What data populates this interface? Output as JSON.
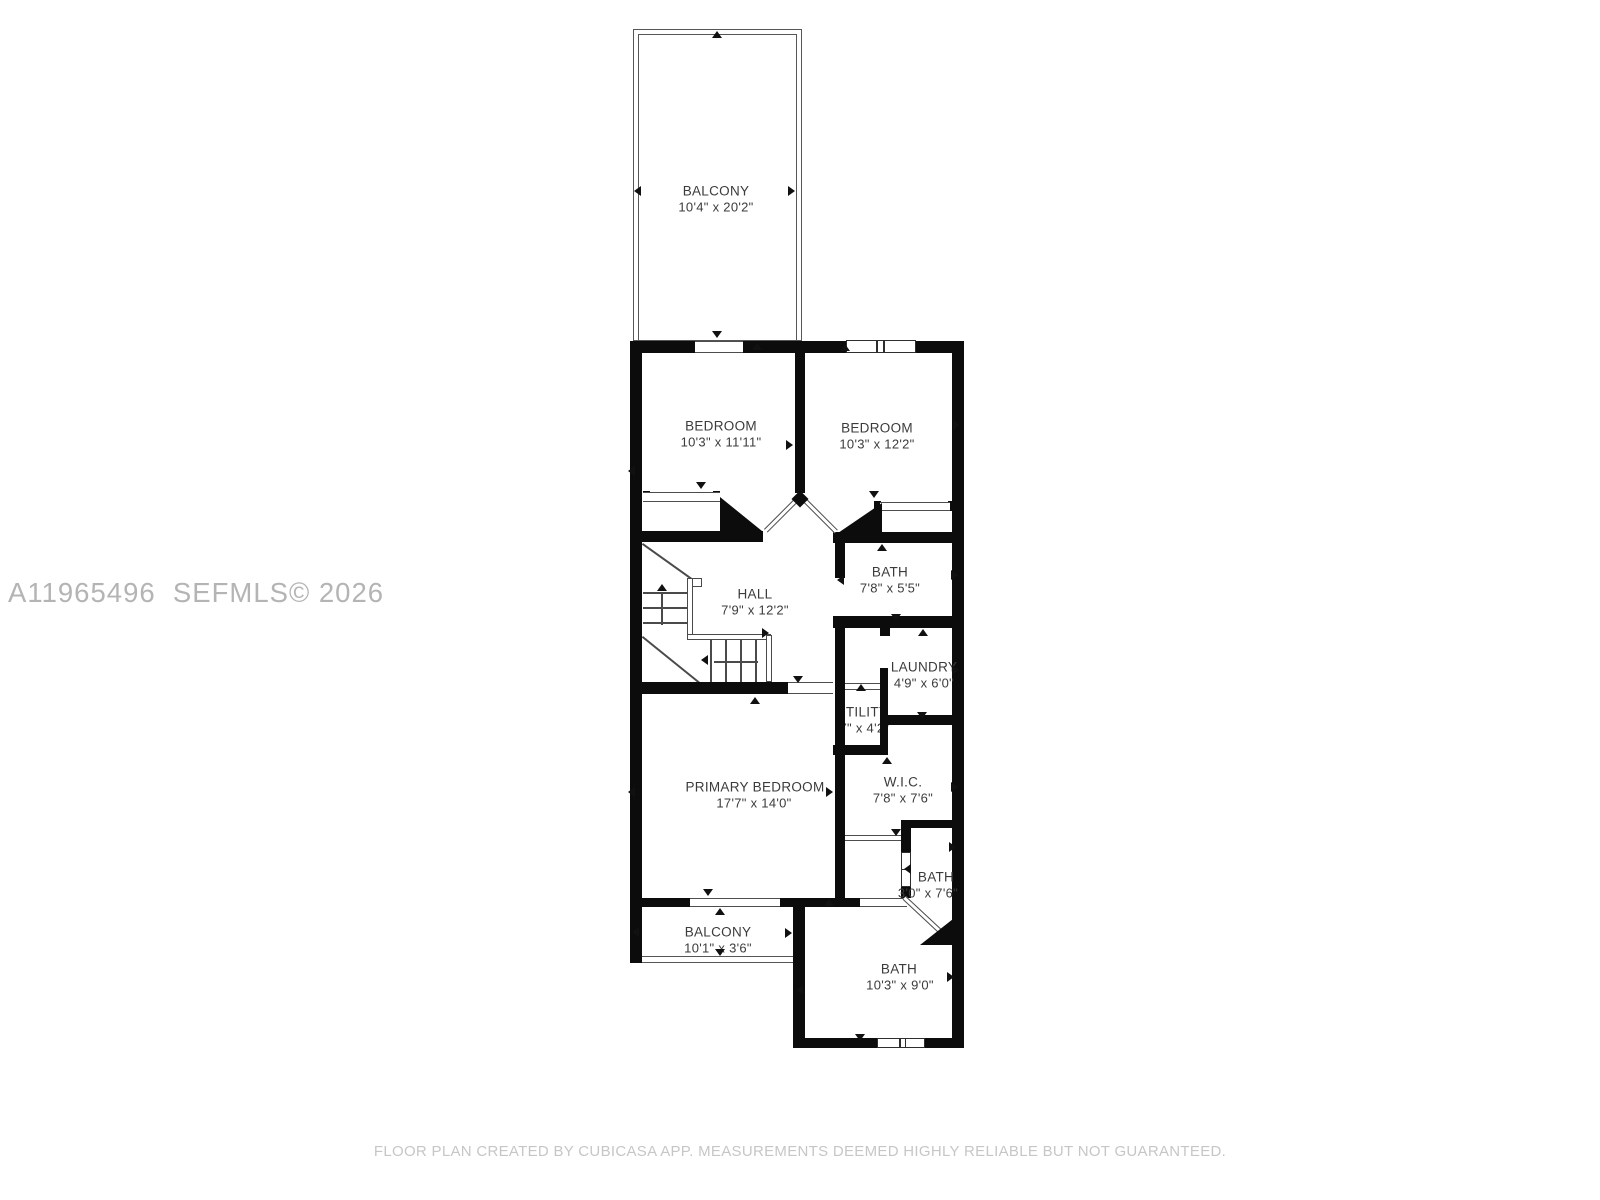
{
  "watermark": "A11965496  SEFMLS© 2026",
  "footer": "FLOOR PLAN CREATED BY CUBICASA APP. MEASUREMENTS DEEMED HIGHLY RELIABLE BUT NOT GUARANTEED.",
  "rooms": [
    {
      "id": "balcony-top",
      "name": "BALCONY",
      "dims": "10'4\" x 20'2\"",
      "nx": 716,
      "ny": 191,
      "dx": 716,
      "dy": 207,
      "under": false
    },
    {
      "id": "bedroom-left",
      "name": "BEDROOM",
      "dims": "10'3\" x 11'11\"",
      "nx": 721,
      "ny": 426,
      "dx": 721,
      "dy": 442,
      "under": false
    },
    {
      "id": "bedroom-right",
      "name": "BEDROOM",
      "dims": "10'3\" x 12'2\"",
      "nx": 877,
      "ny": 428,
      "dx": 877,
      "dy": 444,
      "under": false
    },
    {
      "id": "hall",
      "name": "HALL",
      "dims": "7'9\" x 12'2\"",
      "nx": 755,
      "ny": 594,
      "dx": 755,
      "dy": 610,
      "under": false
    },
    {
      "id": "bath-upper",
      "name": "BATH",
      "dims": "7'8\" x 5'5\"",
      "nx": 890,
      "ny": 572,
      "dx": 890,
      "dy": 588,
      "under": false
    },
    {
      "id": "laundry",
      "name": "LAUNDRY",
      "dims": "4'9\" x 6'0\"",
      "nx": 924,
      "ny": 667,
      "dx": 924,
      "dy": 683,
      "under": false
    },
    {
      "id": "utility",
      "name": "UTILITY",
      "dims": "'7\" x 4'2\"",
      "nx": 862,
      "ny": 712,
      "dx": 863,
      "dy": 728,
      "under": true
    },
    {
      "id": "wic",
      "name": "W.I.C.",
      "dims": "7'8\" x 7'6\"",
      "nx": 903,
      "ny": 782,
      "dx": 903,
      "dy": 798,
      "under": false
    },
    {
      "id": "primary-bedroom",
      "name": "PRIMARY BEDROOM",
      "dims": "17'7\" x 14'0\"",
      "nx": 755,
      "ny": 787,
      "dx": 754,
      "dy": 803,
      "under": false
    },
    {
      "id": "balcony-bottom",
      "name": "BALCONY",
      "dims": "10'1\" x 3'6\"",
      "nx": 718,
      "ny": 932,
      "dx": 718,
      "dy": 948,
      "under": false
    },
    {
      "id": "bath-small",
      "name": "BATH",
      "dims": "3'0\" x 7'6\"",
      "nx": 936,
      "ny": 877,
      "dx": 928,
      "dy": 893,
      "under": false
    },
    {
      "id": "bath-big",
      "name": "BATH",
      "dims": "10'3\" x 9'0\"",
      "nx": 899,
      "ny": 969,
      "dx": 900,
      "dy": 985,
      "under": false
    }
  ],
  "geometry": {
    "walls": [
      [
        630,
        341,
        334,
        12
      ],
      [
        630,
        341,
        12,
        622
      ],
      [
        952,
        341,
        12,
        707
      ],
      [
        795,
        353,
        10,
        140
      ],
      [
        630,
        531,
        133,
        11
      ],
      [
        833,
        532,
        131,
        11
      ],
      [
        835,
        543,
        10,
        35
      ],
      [
        833,
        616,
        131,
        12
      ],
      [
        835,
        628,
        10,
        54
      ],
      [
        630,
        682,
        158,
        12
      ],
      [
        880,
        627,
        10,
        9
      ],
      [
        880,
        668,
        8,
        87
      ],
      [
        835,
        682,
        10,
        216
      ],
      [
        880,
        715,
        84,
        10
      ],
      [
        833,
        745,
        55,
        10
      ],
      [
        901,
        820,
        63,
        8
      ],
      [
        901,
        828,
        10,
        24
      ],
      [
        901,
        887,
        10,
        11
      ],
      [
        630,
        898,
        60,
        9
      ],
      [
        780,
        898,
        15,
        9
      ],
      [
        793,
        898,
        12,
        150
      ],
      [
        805,
        898,
        55,
        9
      ],
      [
        793,
        1038,
        171,
        10
      ],
      [
        643,
        491,
        7,
        11
      ],
      [
        713,
        491,
        7,
        11
      ],
      [
        874,
        501,
        7,
        10
      ],
      [
        948,
        501,
        7,
        10
      ]
    ],
    "openings": [
      [
        695,
        341,
        48,
        12
      ],
      [
        643,
        492,
        77,
        10
      ],
      [
        880,
        502,
        70,
        9
      ],
      [
        788,
        682,
        45,
        12
      ],
      [
        845,
        683,
        35,
        7
      ],
      [
        845,
        835,
        56,
        6
      ],
      [
        690,
        898,
        90,
        9
      ],
      [
        860,
        898,
        47,
        9
      ]
    ],
    "windows": [
      [
        846,
        340,
        70,
        13,
        [
          0.42,
          0.52
        ]
      ],
      [
        901,
        852,
        10,
        35,
        [
          0.45
        ]
      ],
      [
        877,
        1038,
        48,
        10,
        [
          0.44,
          0.56
        ]
      ]
    ],
    "thin_rects": [
      [
        633,
        29,
        169,
        312
      ],
      [
        638,
        34,
        159,
        307
      ]
    ],
    "rails": [
      [
        630,
        956,
        163,
        7
      ]
    ],
    "diagonals": [
      [
        764,
        529,
        45,
        -45
      ],
      [
        806,
        498,
        45,
        45
      ],
      [
        906,
        896,
        58,
        43
      ]
    ],
    "diamonds": [
      [
        794,
        493,
        12,
        12
      ]
    ],
    "triangles": [
      [
        720,
        497,
        42,
        34,
        "a"
      ],
      [
        838,
        503,
        44,
        30,
        "b"
      ],
      [
        920,
        919,
        33,
        26,
        "b"
      ]
    ],
    "stair_lines": [
      [
        643,
        543,
        60,
        35.5
      ],
      [
        643,
        592,
        44,
        0
      ],
      [
        643,
        607,
        44,
        0
      ],
      [
        643,
        622,
        44,
        0
      ],
      [
        663,
        592,
        33,
        90
      ],
      [
        643,
        636,
        73,
        38.9
      ],
      [
        712,
        640,
        42,
        90
      ],
      [
        727,
        640,
        42,
        90
      ],
      [
        742,
        640,
        42,
        90
      ],
      [
        757,
        640,
        42,
        90
      ],
      [
        714,
        661,
        44,
        0
      ]
    ],
    "stair_rects": [
      [
        687,
        578,
        6,
        62
      ],
      [
        687,
        634,
        84,
        6
      ],
      [
        692,
        578,
        10,
        9
      ],
      [
        766,
        635,
        6,
        47
      ]
    ],
    "markers": [
      [
        712,
        31,
        "up"
      ],
      [
        712,
        331,
        "down"
      ],
      [
        634,
        186,
        "left"
      ],
      [
        788,
        186,
        "right"
      ],
      [
        752,
        343,
        "up"
      ],
      [
        628,
        466,
        "left"
      ],
      [
        786,
        440,
        "right"
      ],
      [
        696,
        482,
        "down"
      ],
      [
        840,
        344,
        "up"
      ],
      [
        953,
        420,
        "right"
      ],
      [
        869,
        491,
        "down"
      ],
      [
        762,
        628,
        "right"
      ],
      [
        793,
        676,
        "down"
      ],
      [
        877,
        544,
        "up"
      ],
      [
        951,
        570,
        "right"
      ],
      [
        837,
        575,
        "left"
      ],
      [
        891,
        614,
        "down"
      ],
      [
        918,
        629,
        "up"
      ],
      [
        952,
        665,
        "right"
      ],
      [
        917,
        712,
        "down"
      ],
      [
        856,
        684,
        "up"
      ],
      [
        882,
        757,
        "up"
      ],
      [
        951,
        782,
        "right"
      ],
      [
        891,
        829,
        "down"
      ],
      [
        750,
        697,
        "up"
      ],
      [
        628,
        787,
        "left"
      ],
      [
        826,
        787,
        "right"
      ],
      [
        703,
        889,
        "down"
      ],
      [
        715,
        908,
        "up"
      ],
      [
        632,
        927,
        "left"
      ],
      [
        785,
        928,
        "right"
      ],
      [
        715,
        949,
        "down"
      ],
      [
        824,
        899,
        "up"
      ],
      [
        796,
        985,
        "left"
      ],
      [
        947,
        972,
        "right"
      ],
      [
        855,
        1034,
        "down"
      ],
      [
        904,
        864,
        "left"
      ],
      [
        949,
        842,
        "right"
      ],
      [
        657,
        584,
        "up"
      ],
      [
        701,
        655,
        "left"
      ]
    ]
  }
}
